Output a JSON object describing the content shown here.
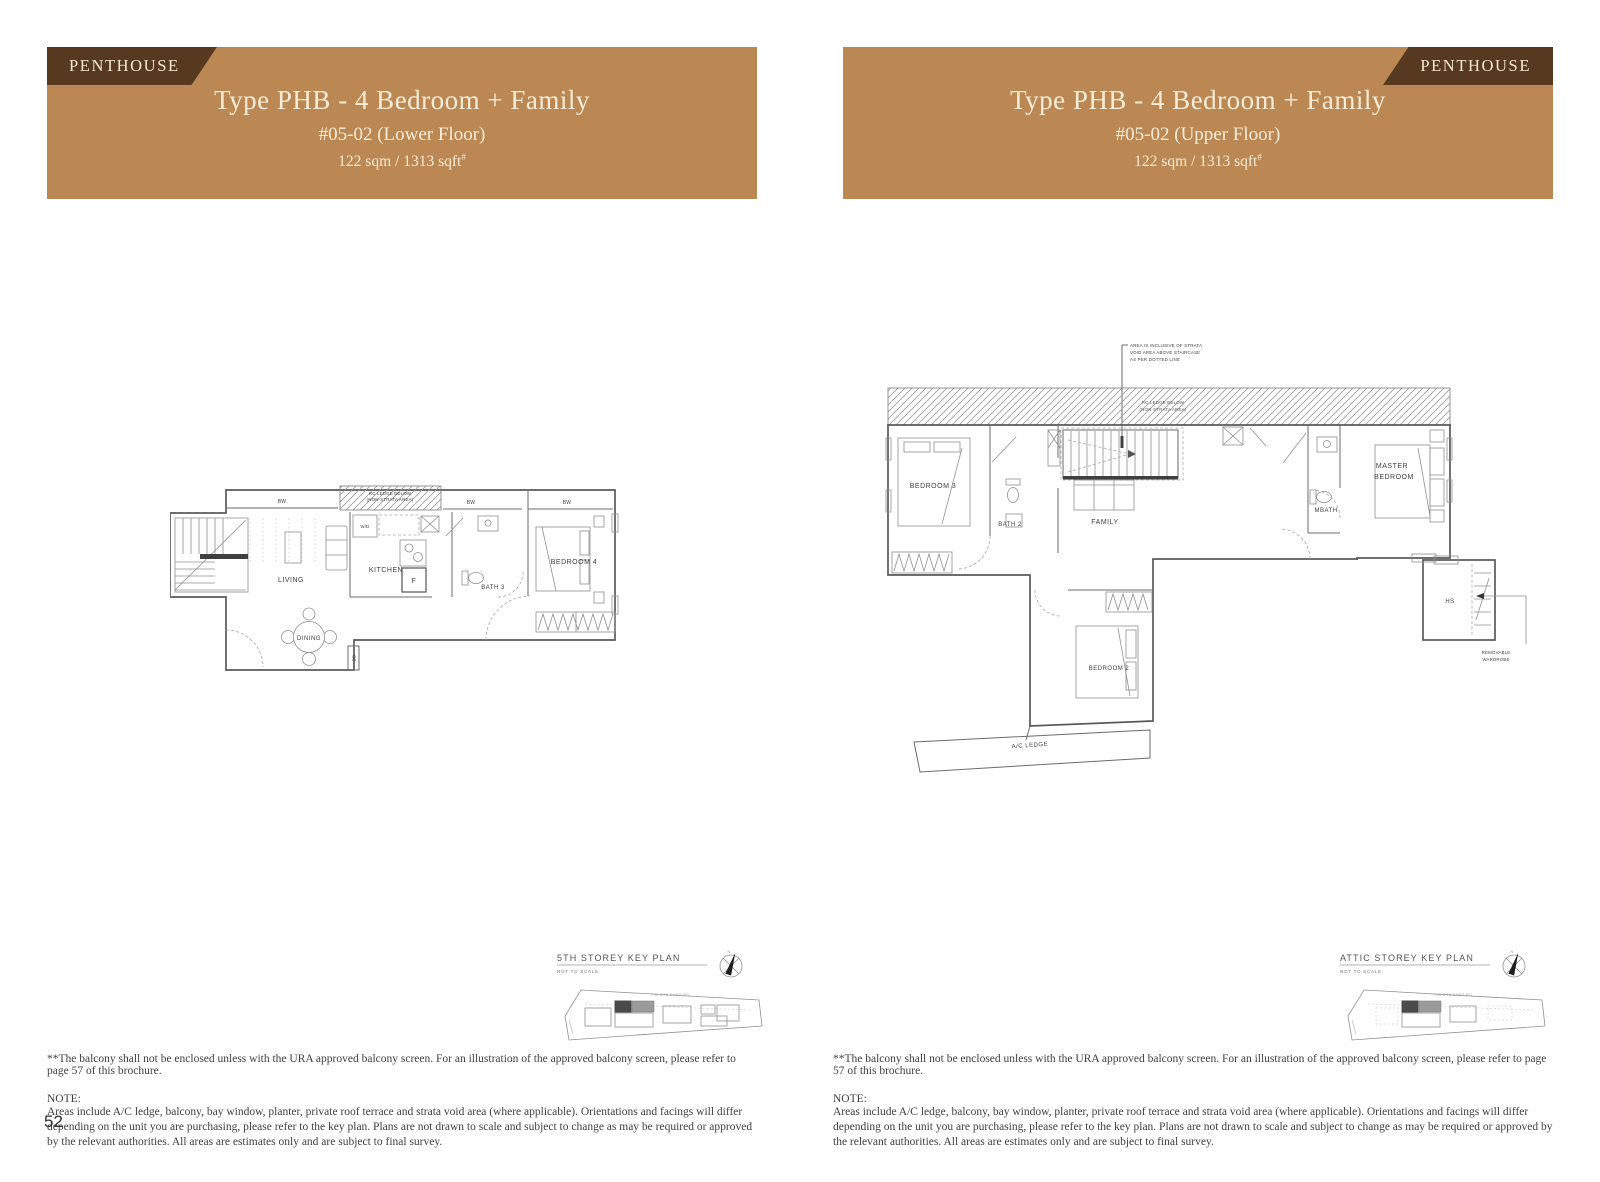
{
  "colors": {
    "band_bg": "#bb8853",
    "tab_bg": "#56391f",
    "band_text": "#f7ecd8",
    "line": "#595959"
  },
  "banner_left": {
    "tag": "PENTHOUSE",
    "title": "Type PHB - 4 Bedroom + Family",
    "unit": "#05-02 (Lower Floor)",
    "area": "122 sqm / 1313 sqft",
    "area_sup": "#"
  },
  "banner_right": {
    "tag": "PENTHOUSE",
    "title": "Type PHB - 4 Bedroom + Family",
    "unit": "#05-02 (Upper Floor)",
    "area": "122 sqm / 1313 sqft",
    "area_sup": "#"
  },
  "lower_plan": {
    "bw": "BW",
    "ledge_line1": "RC LEDGE BELOW",
    "ledge_line2": "(NON-STRATA AREA)",
    "labels": {
      "living": "LIVING",
      "dining": "DINING",
      "kitchen": "KITCHEN",
      "wd": "W/D",
      "fridge": "F",
      "bath3": "BATH 3",
      "bedroom4": "BEDROOM 4",
      "db": "DB"
    }
  },
  "upper_plan": {
    "ledge_line1": "RC LEDGE BELOW",
    "ledge_line2": "(NON-STRATA AREA)",
    "annotation_line1": "AREA IS INCLUSIVE OF STRATA",
    "annotation_line2": "VOID AREA ABOVE STAIRCASE",
    "annotation_line3": "AS PER DOTTED LINE",
    "labels": {
      "bedroom3": "BEDROOM 3",
      "bath2": "BATH 2",
      "family": "FAMILY",
      "mbath": "MBATH",
      "master_line1": "MASTER",
      "master_line2": "BEDROOM",
      "bedroom2": "BEDROOM 2",
      "hs": "HS",
      "ac_ledge": "A/C LEDGE",
      "removable_line1": "REMOVABLE",
      "removable_line2": "WARDROBE"
    }
  },
  "keyplan_left": {
    "title": "5TH STOREY KEY PLAN",
    "subtitle": "NOT TO SCALE",
    "north_label": "N",
    "road_label": "YIO CHU KANG RD"
  },
  "keyplan_right": {
    "title": "ATTIC STOREY KEY PLAN",
    "subtitle": "NOT TO SCALE",
    "north_label": "N",
    "road_label": "YIO CHU KANG RD"
  },
  "footnotes": {
    "balcony": "**The balcony shall not be enclosed unless with the URA approved balcony screen. For an illustration of the approved balcony screen, please refer to page 57 of this brochure.",
    "note_title": "NOTE:",
    "note_body": "Areas include A/C ledge, balcony, bay window, planter, private roof terrace and strata void area (where applicable). Orientations and facings will differ depending on the unit you are purchasing, please refer to the key plan. Plans are not drawn to scale and subject to change as may be required or approved by the relevant authorities. All areas are estimates only and are subject to final survey."
  },
  "page_number": "52"
}
